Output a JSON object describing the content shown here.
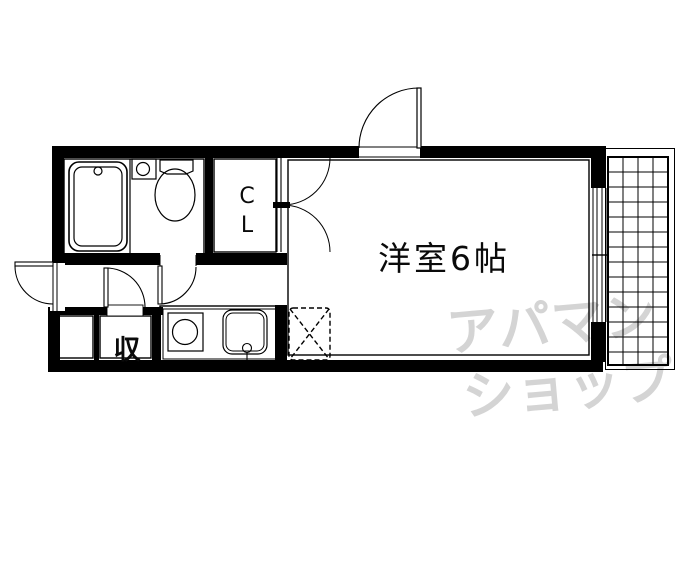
{
  "plan": {
    "rooms": {
      "main_room": {
        "label": "洋室6帖"
      },
      "closet": {
        "label_line1": "C",
        "label_line2": "L"
      },
      "storage_closet": {
        "label": "収"
      }
    },
    "fixtures": {
      "unit_bath": [
        "bathtub-icon",
        "wash-basin-icon",
        "toilet-icon"
      ],
      "kitchen": [
        "stove-burner-icon",
        "kitchen-sink-icon",
        "faucet-icon"
      ],
      "laundry_space": "washer-space-dashed-box",
      "balcony": "balcony-grid-hatch",
      "doors": [
        "entrance-door-swing",
        "side-door-swing",
        "bathroom-door-swing",
        "storage-door-swing",
        "closet-double-door-swing"
      ],
      "window": "sliding-window"
    },
    "watermark": {
      "line1": "アパマン",
      "line2": "ショップ",
      "full_text": "アパマンショップ"
    },
    "colors": {
      "line": "#000000",
      "background": "#ffffff",
      "watermark": "#d4d4d4"
    }
  }
}
